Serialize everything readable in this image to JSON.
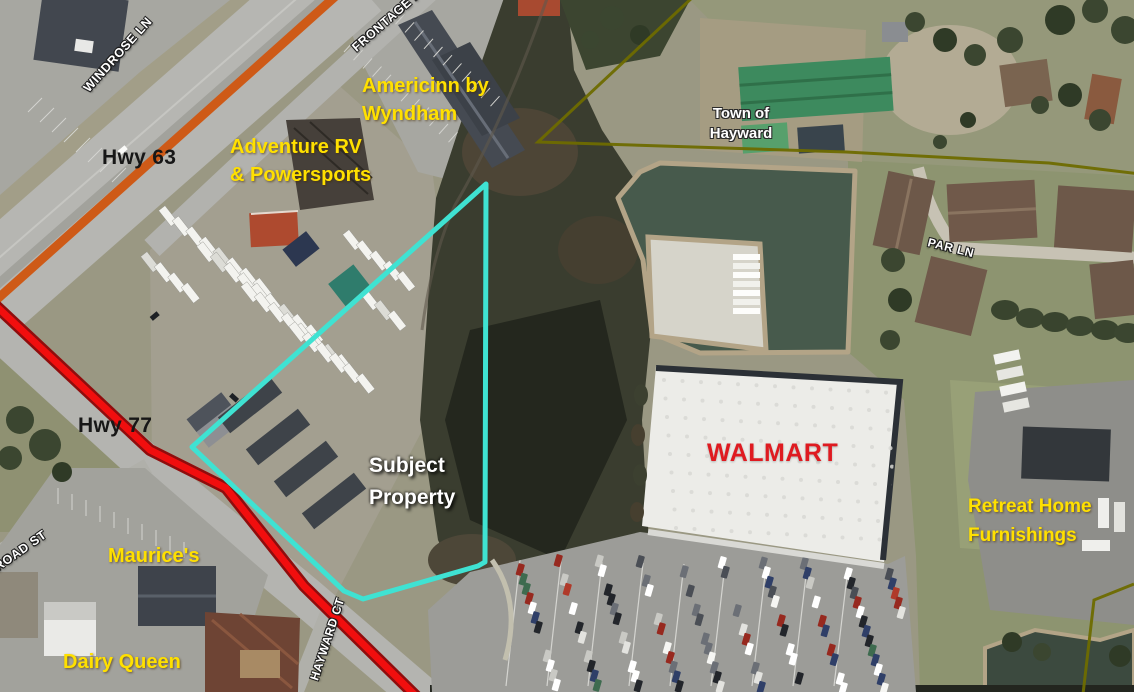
{
  "map": {
    "description": "Aerial parcel map, Hayward WI area",
    "labels": {
      "windrose_ln": "WINDROSE LN",
      "frontage_rd": "FRONTAGE RD",
      "hwy_63": "Hwy 63",
      "hwy_77": "Hwy 77",
      "railroad_st": "RAILROAD ST",
      "hayward_ct": "HAYWARD CT",
      "par_ln": "PAR LN",
      "americinn_line1": "Americinn by",
      "americinn_line2": "Wyndham",
      "adventure_line1": "Adventure RV",
      "adventure_line2": "& Powersports",
      "town_line1": "Town of",
      "town_line2": "Hayward",
      "walmart": "WALMART",
      "subject_line1": "Subject",
      "subject_line2": "Property",
      "maurices": "Maurice's",
      "dairy_queen": "Dairy Queen",
      "retreat_line1": "Retreat Home",
      "retreat_line2": "Furnishings"
    },
    "colors": {
      "parcel_outline": "#3fe2d2",
      "hwy77_line": "#f10e0e",
      "hwy77_line_edge": "#8f0d0d",
      "hwy63_line": "#ce5a17",
      "municipal_boundary": "#6e6b00",
      "label_yellow": "#ffe000",
      "label_white": "#ffffff",
      "label_black": "#171717",
      "walmart_red": "#df1a20"
    }
  }
}
